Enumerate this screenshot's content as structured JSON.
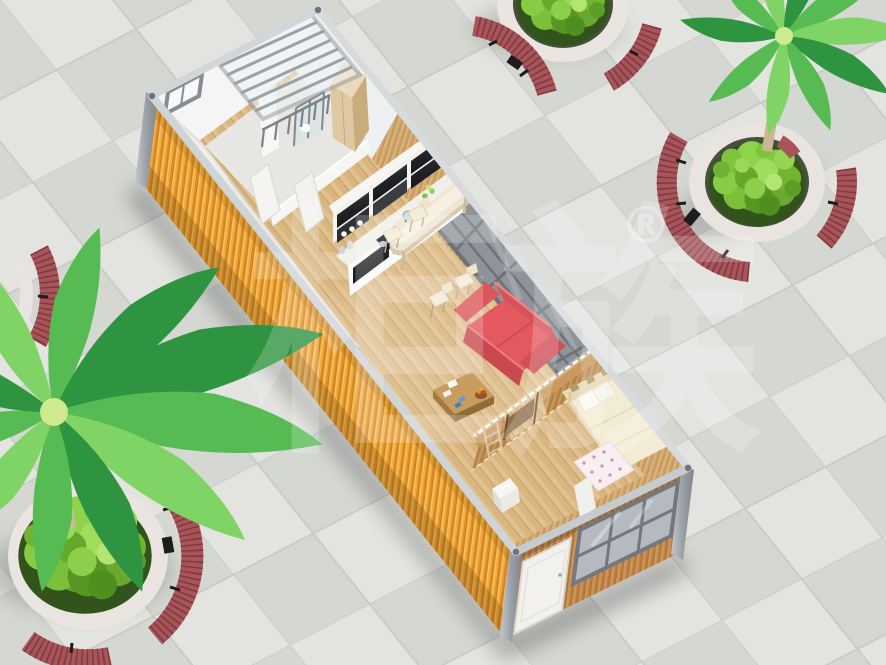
{
  "watermark": {
    "text": "柜族",
    "registered_symbol": "®"
  },
  "scene": {
    "objects": [
      "tiled-plaza",
      "container-house",
      "louvered-glass-roof",
      "bathroom",
      "wardrobe",
      "kitchen-cabinets",
      "bar-counter",
      "red-sofa",
      "coffee-table",
      "partition-wall",
      "bedroom-bed",
      "pink-rug",
      "end-wall-window",
      "end-wall-door",
      "planter-top-right",
      "planter-top-center",
      "planter-bottom-left",
      "planter-left-partial",
      "palm-tree-top-right",
      "palm-tree-bottom-left",
      "curved-red-benches"
    ]
  },
  "colors": {
    "tile_light": "#e3e4e0",
    "tile_dark": "#d5d7d3",
    "tile_grout": "#c8cac6",
    "container_orange": "#f3ab42",
    "container_orange_shade": "#d88e28",
    "metal_frame": "#9aa0a6",
    "rim_light": "#d6dade",
    "wood_floor": "#e1c18f",
    "wood_wall_light": "#d9b27c",
    "wood_wall_dark": "#b5854a",
    "end_wall_wood": "#cd9458",
    "sofa_red": "#e4595f",
    "bench_red": "#a85459",
    "planter_stone": "#eae5e1",
    "foliage_green": "#74b835",
    "palm_green": "#55bb52",
    "counter_cream": "#efe5d2",
    "cabinet_panel_dark": "#2e3033",
    "bed_cream": "#f3ecd4",
    "rug_pink": "#e08aa2",
    "glass_gray": "#9ea4a9",
    "white_wall": "#f4f4f2"
  }
}
